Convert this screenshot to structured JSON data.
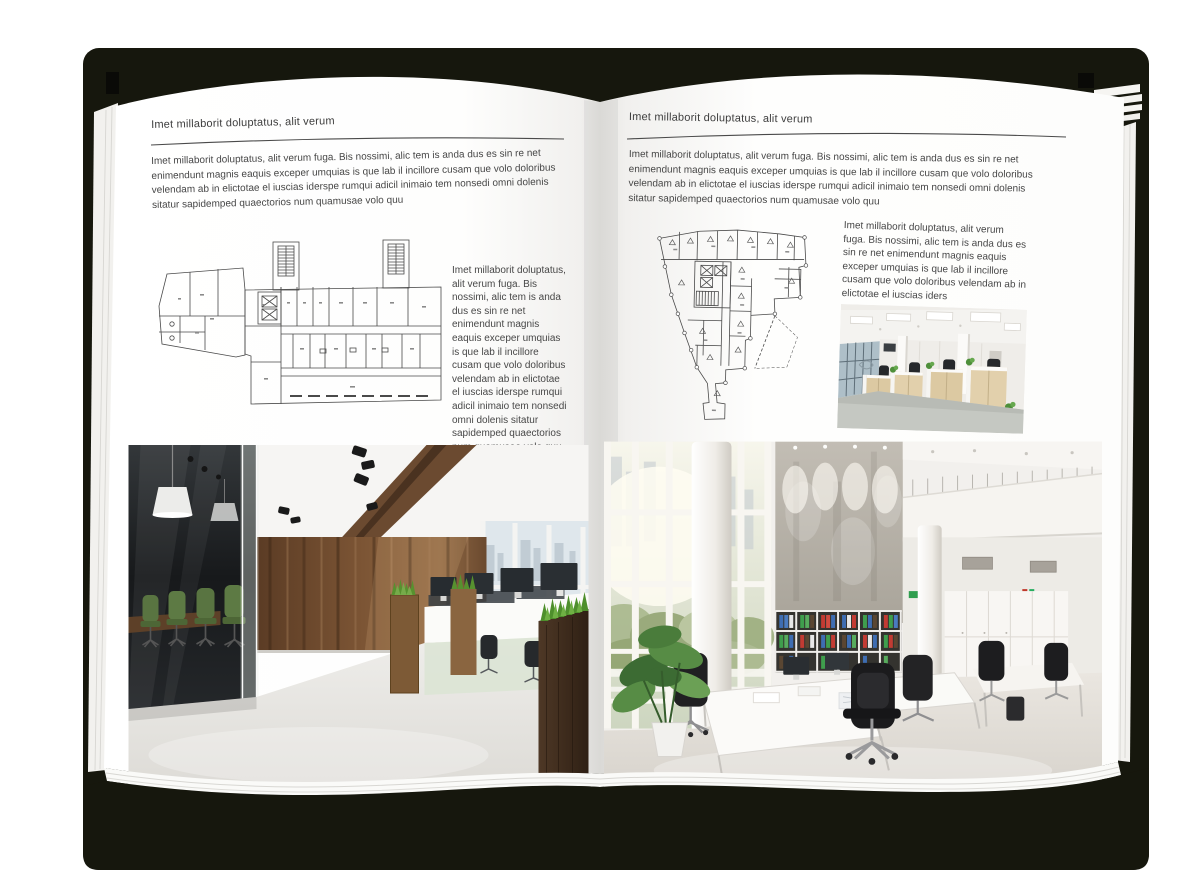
{
  "document": {
    "type": "open magazine spread mockup",
    "colors": {
      "cover": "#16170D",
      "page": "#FFFFFF",
      "heading_text": "#3D3D3D",
      "body_text": "#474747",
      "plan_line": "#4A4A4A",
      "wood_accent": "#6B4A2F",
      "chair_green": "#597441",
      "grass_green": "#57912F"
    }
  },
  "left_page": {
    "header": "Imet millaborit doluptatus, alit verum",
    "intro": "Imet millaborit doluptatus, alit verum fuga. Bis nossimi, alic tem is anda dus es sin re net enimendunt magnis eaquis exceper umquias is que lab il incillore cusam que volo doloribus velendam ab in elictotae el iuscias iderspe rumqui adicil inimaio tem nonsedi omni dolenis sitatur sapidemped quaectorios num quamusae volo quu",
    "caption": "Imet millaborit doluptatus, alit verum fuga. Bis nossimi, alic tem is anda dus es sin re net enimendunt magnis eaquis exceper umquias is que lab il incillore cusam que volo doloribus velendam ab in elictotae el iuscias iderspe rumqui adicil inimaio tem nonsedi omni dolenis sitatur sapidemped quaectorios num quamusae volo quu"
  },
  "right_page": {
    "header": "Imet millaborit doluptatus, alit verum",
    "intro": "Imet millaborit doluptatus, alit verum fuga. Bis nossimi, alic tem is anda dus es sin re net enimendunt magnis eaquis exceper umquias is que lab il incillore cusam que volo doloribus velendam ab in elictotae el iuscias iderspe rumqui adicil inimaio tem nonsedi omni dolenis sitatur sapidemped quaectorios num quamusae volo quu",
    "caption": "Imet millaborit doluptatus, alit verum fuga. Bis nossimi, alic tem is anda dus es sin re net enimendunt magnis eaquis exceper umquias is que lab il incillore cusam que volo doloribus velendam ab in elictotae el iuscias iders"
  }
}
